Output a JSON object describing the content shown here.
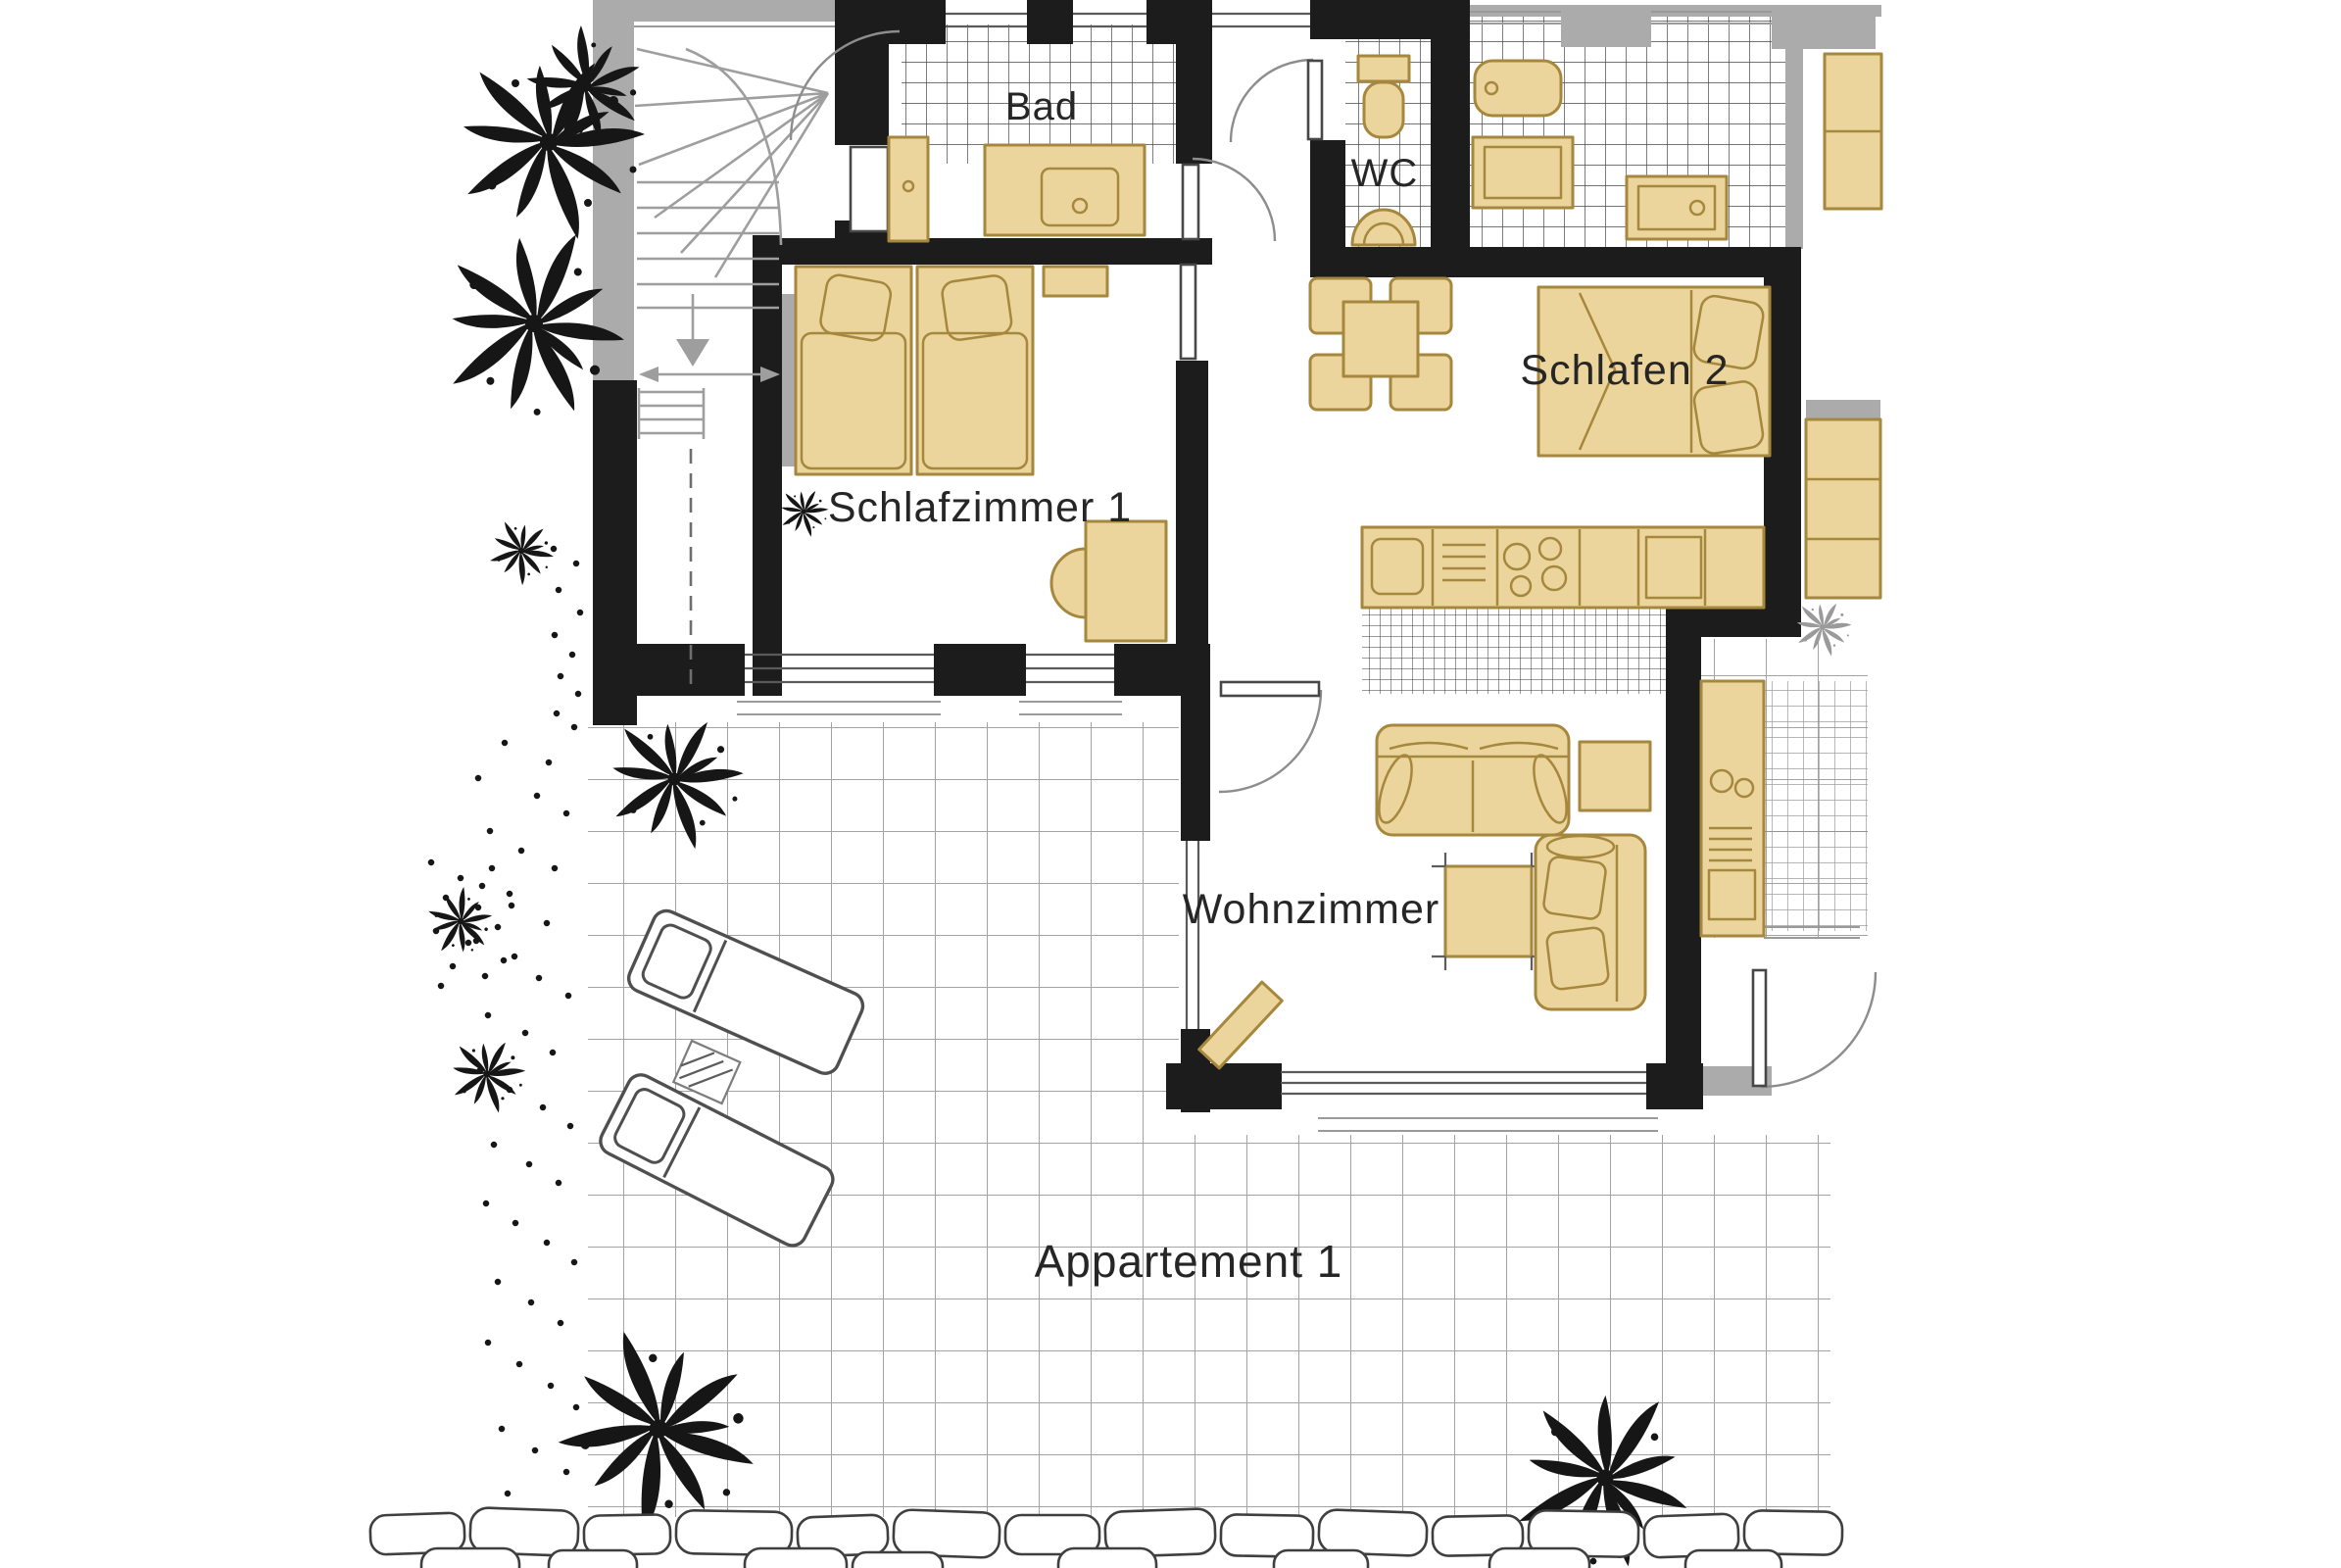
{
  "document": {
    "kind": "apartment floor plan drawing",
    "unit": {
      "label": "Appartement 1"
    },
    "rooms": [
      {
        "id": "bad",
        "label": "Bad"
      },
      {
        "id": "wc",
        "label": "WC"
      },
      {
        "id": "schlafen2",
        "label": "Schlafen 2"
      },
      {
        "id": "schlafzimmer1",
        "label": "Schlafzimmer 1"
      },
      {
        "id": "wohnzimmer",
        "label": "Wohnzimmer"
      }
    ],
    "fixtures": {
      "bad": [
        "vanity-sink",
        "washer-cabinet",
        "tiled-floor"
      ],
      "wc": [
        "toilet",
        "wall-sink",
        "tiled-floor"
      ],
      "schlafzimmer1": [
        "twin-beds",
        "pillows",
        "wall-shelf",
        "desk",
        "chair"
      ],
      "schlafen2": [
        "double-bed",
        "pillows"
      ],
      "kitchen": [
        "counter",
        "sink",
        "cooktop",
        "vent-grill",
        "appliance"
      ],
      "wohnzimmer": [
        "sofa",
        "corner-sofa",
        "side-table",
        "coffee-table",
        "bench"
      ],
      "outside": [
        "staircase",
        "terrace-tiles",
        "sun-loungers",
        "side-table",
        "plants",
        "stone-wall"
      ],
      "neighbor": [
        "bathtub",
        "shower",
        "wardrobes",
        "kitchenette",
        "entry-door"
      ]
    },
    "colors": {
      "paper": "#ffffff",
      "wall": "#1c1c1c",
      "neighbor_wall": "#ababab",
      "furniture_fill": "#ecd59c",
      "furniture_stroke": "#a5873e",
      "tile_line": "#474747",
      "kitchen_tile_line": "#343434",
      "terrace_line": "#a3a3a3",
      "stair_line": "#9e9e9e",
      "door_arc": "#8d8d8d",
      "glazing": "#5a5a5a",
      "sill": "#9a9a9a",
      "ink": "#161616",
      "label_ink": "#262626",
      "lounger_stroke": "#4f4f4f",
      "stone_line": "#3f3f3f"
    }
  }
}
